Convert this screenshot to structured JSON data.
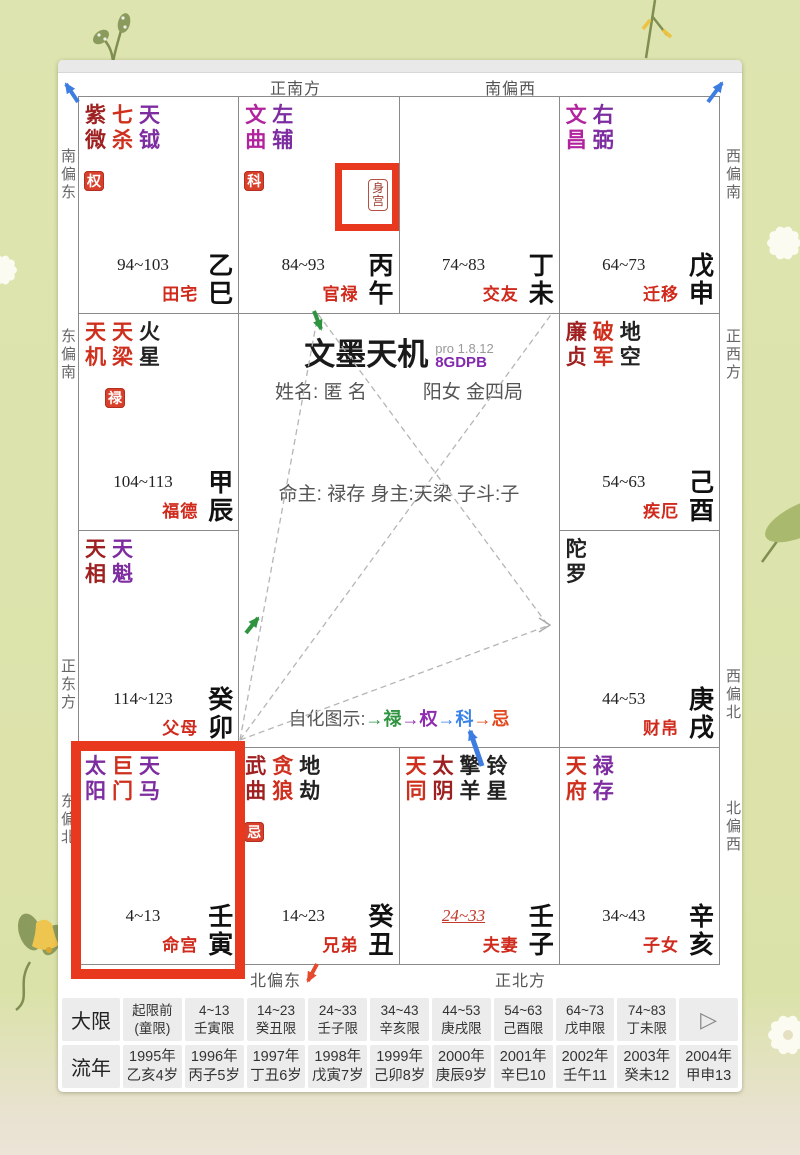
{
  "app": {
    "title": "文墨天机",
    "version": "pro 1.8.12",
    "edition": "8GDPB"
  },
  "colors": {
    "red": "#cf2f1d",
    "darkred": "#9e2020",
    "purple": "#7e2da0",
    "magenta": "#b2239e",
    "black": "#222222",
    "badge_bg": "#d8402c",
    "highlight_frame": "#e8391f",
    "palace_name": "#d02a1c",
    "arrows": {
      "blue": "#3d7ce0",
      "green": "#2f9440",
      "red": "#e64a2e",
      "gray": "#aaaaaa"
    }
  },
  "compass": {
    "top": [
      "正南方",
      "南偏西"
    ],
    "bottom": [
      "北偏东",
      "正北方"
    ],
    "left": [
      "南偏东",
      "东偏南",
      "正东方",
      "东偏北"
    ],
    "right": [
      "西偏南",
      "正西方",
      "西偏北",
      "北偏西"
    ]
  },
  "center": {
    "name_label": "姓名:",
    "name_value": "匿 名",
    "gender_bureau": "阳女 金四局",
    "masters": "命主: 禄存 身主:天梁 子斗:子",
    "legend_label": "自化图示:",
    "legend": [
      {
        "text": "→禄",
        "color": "#2f9440"
      },
      {
        "text": "→权",
        "color": "#8e2bb0"
      },
      {
        "text": "→科",
        "color": "#3b82e8"
      },
      {
        "text": "→忌",
        "color": "#e2491f"
      }
    ]
  },
  "palaces": [
    {
      "name": "田宅",
      "age": "94~103",
      "stem": "乙",
      "branch": "巳",
      "stars": [
        [
          "紫微",
          "darkred"
        ],
        [
          "七杀",
          "red"
        ],
        [
          "天钺",
          "purple"
        ]
      ],
      "badge": {
        "text": "权",
        "col": 0
      }
    },
    {
      "name": "官禄",
      "age": "84~93",
      "stem": "丙",
      "branch": "午",
      "stars": [
        [
          "文曲",
          "magenta"
        ],
        [
          "左辅",
          "purple"
        ]
      ],
      "badge": {
        "text": "科",
        "col": 0
      },
      "body_palace": true,
      "body_palace_label": "身宫"
    },
    {
      "name": "交友",
      "age": "74~83",
      "stem": "丁",
      "branch": "未",
      "stars": []
    },
    {
      "name": "迁移",
      "age": "64~73",
      "stem": "戊",
      "branch": "申",
      "stars": [
        [
          "文昌",
          "magenta"
        ],
        [
          "右弼",
          "purple"
        ]
      ]
    },
    {
      "name": "福德",
      "age": "104~113",
      "stem": "甲",
      "branch": "辰",
      "stars": [
        [
          "天机",
          "red"
        ],
        [
          "天梁",
          "red"
        ],
        [
          "火星",
          "black"
        ]
      ],
      "badge": {
        "text": "禄",
        "col": 1
      }
    },
    {
      "name": "疾厄",
      "age": "54~63",
      "stem": "己",
      "branch": "酉",
      "stars": [
        [
          "廉贞",
          "darkred"
        ],
        [
          "破军",
          "red"
        ],
        [
          "地空",
          "black"
        ]
      ]
    },
    {
      "name": "父母",
      "age": "114~123",
      "stem": "癸",
      "branch": "卯",
      "stars": [
        [
          "天相",
          "darkred"
        ],
        [
          "天魁",
          "purple"
        ]
      ]
    },
    {
      "name": "财帛",
      "age": "44~53",
      "stem": "庚",
      "branch": "戌",
      "stars": [
        [
          "陀罗",
          "black"
        ]
      ]
    },
    {
      "name": "命宫",
      "age": "4~13",
      "stem": "壬",
      "branch": "寅",
      "stars": [
        [
          "太阳",
          "purple"
        ],
        [
          "巨门",
          "red"
        ],
        [
          "天马",
          "purple"
        ]
      ],
      "highlighted": true
    },
    {
      "name": "兄弟",
      "age": "14~23",
      "stem": "癸",
      "branch": "丑",
      "stars": [
        [
          "武曲",
          "darkred"
        ],
        [
          "贪狼",
          "red"
        ],
        [
          "地劫",
          "black"
        ]
      ],
      "badge": {
        "text": "忌",
        "col": 0
      }
    },
    {
      "name": "夫妻",
      "age": "24~33",
      "stem": "壬",
      "branch": "子",
      "stars": [
        [
          "天同",
          "red"
        ],
        [
          "太阴",
          "darkred"
        ],
        [
          "擎羊",
          "black"
        ],
        [
          "铃星",
          "black"
        ]
      ],
      "age_highlight": true
    },
    {
      "name": "子女",
      "age": "34~43",
      "stem": "辛",
      "branch": "亥",
      "stars": [
        [
          "天府",
          "red"
        ],
        [
          "禄存",
          "purple"
        ]
      ]
    }
  ],
  "tables": {
    "play_icon": "▷",
    "daxian": {
      "header": "大限",
      "cells": [
        [
          "起限前",
          "(童限)"
        ],
        [
          "4~13",
          "壬寅限"
        ],
        [
          "14~23",
          "癸丑限"
        ],
        [
          "24~33",
          "壬子限"
        ],
        [
          "34~43",
          "辛亥限"
        ],
        [
          "44~53",
          "庚戌限"
        ],
        [
          "54~63",
          "己酉限"
        ],
        [
          "64~73",
          "戊申限"
        ],
        [
          "74~83",
          "丁未限"
        ]
      ]
    },
    "liunian": {
      "header": "流年",
      "cells": [
        [
          "1995年",
          "乙亥4岁"
        ],
        [
          "1996年",
          "丙子5岁"
        ],
        [
          "1997年",
          "丁丑6岁"
        ],
        [
          "1998年",
          "戊寅7岁"
        ],
        [
          "1999年",
          "己卯8岁"
        ],
        [
          "2000年",
          "庚辰9岁"
        ],
        [
          "2001年",
          "辛巳10"
        ],
        [
          "2002年",
          "壬午11"
        ],
        [
          "2003年",
          "癸未12"
        ],
        [
          "2004年",
          "甲申13"
        ]
      ]
    }
  }
}
